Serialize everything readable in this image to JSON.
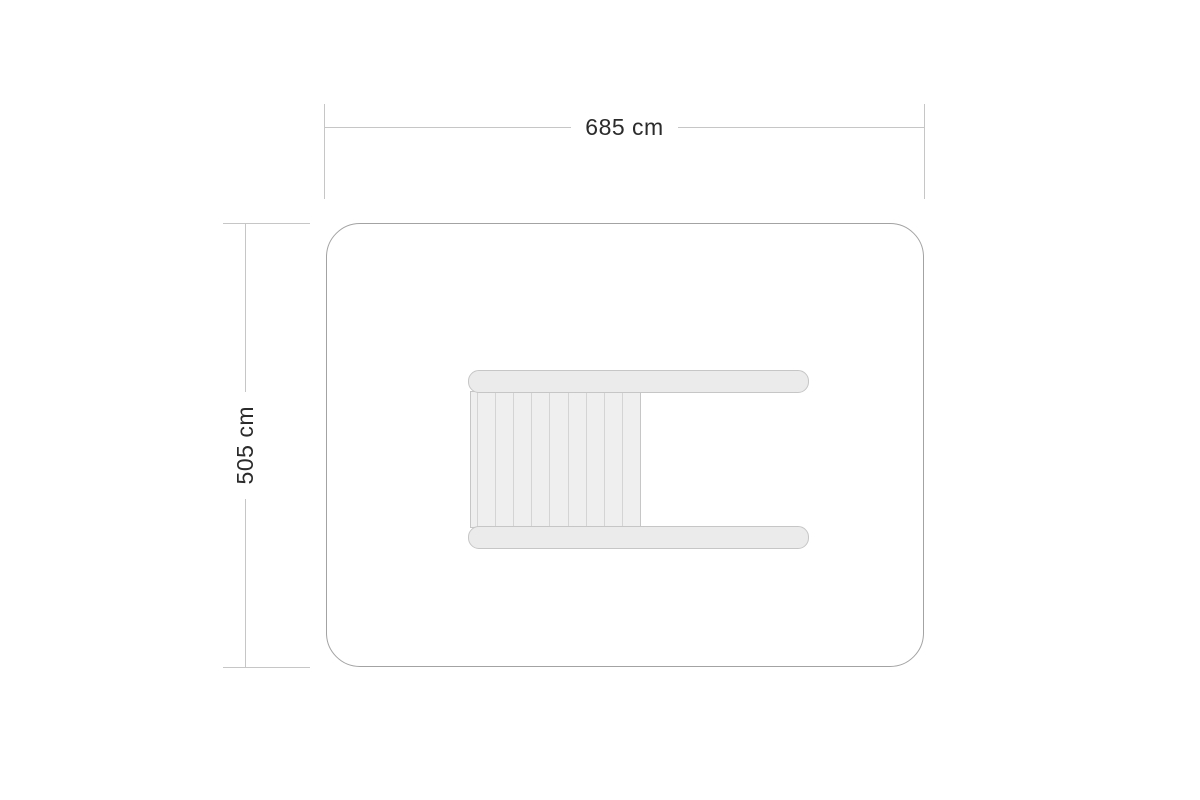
{
  "diagram": {
    "title": "floor plan with outer dimensions",
    "width_dimension": {
      "label": "685 cm",
      "orientation": "horizontal"
    },
    "height_dimension": {
      "label": "505 cm",
      "orientation": "vertical"
    },
    "furniture": {
      "slat_count": 10
    },
    "colors": {
      "background": "#ffffff",
      "dim_line": "#c6c6c6",
      "outline": "#a3a3a3",
      "text": "#2b2b2b",
      "furniture_fill": "#ebebeb",
      "furniture_border": "#c6c6c6",
      "slat_fill": "#efefef",
      "slat_line": "#d4d4d4"
    }
  }
}
